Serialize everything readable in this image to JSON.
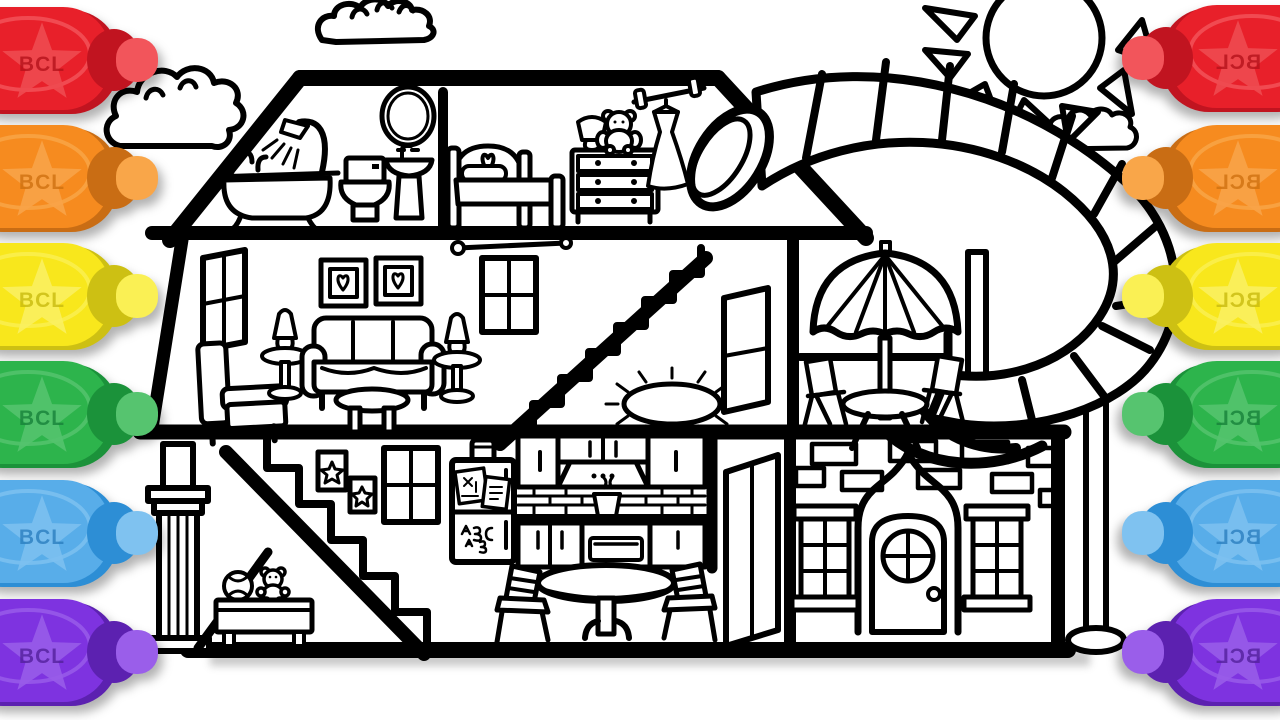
{
  "canvas": {
    "width": 1280,
    "height": 720,
    "background": "#ffffff",
    "line_color": "#000000"
  },
  "markers": {
    "label": "BCL",
    "left_order": [
      "red",
      "orange",
      "yellow",
      "green",
      "blue",
      "purple"
    ],
    "right_order": [
      "red",
      "orange",
      "yellow",
      "green",
      "blue",
      "purple"
    ],
    "palette": [
      {
        "name": "red",
        "body": "#e8202a",
        "shade": "#c11420",
        "tip": "#f2555b",
        "star": "#ee4a50",
        "label_color": "#b5121b",
        "vars": "--body:#e8202a;--shade:#c11420;--tip:#f2555b;--star:#ee4a50;--label:#b5121b"
      },
      {
        "name": "orange",
        "body": "#f68b1f",
        "shade": "#c96d14",
        "tip": "#f9a649",
        "star": "#f8a348",
        "label_color": "#cf7110",
        "vars": "--body:#f68b1f;--shade:#c96d14;--tip:#f9a649;--star:#f8a348;--label:#cf7110"
      },
      {
        "name": "yellow",
        "body": "#f8e71c",
        "shade": "#cdc013",
        "tip": "#faf054",
        "star": "#faef60",
        "label_color": "#c9bb0f",
        "vars": "--body:#f8e71c;--shade:#cdc013;--tip:#faf054;--star:#faef60;--label:#c9bb0f"
      },
      {
        "name": "green",
        "body": "#2db44c",
        "shade": "#1b923a",
        "tip": "#56c46f",
        "star": "#54c36e",
        "label_color": "#17823a",
        "vars": "--body:#2db44c;--shade:#1b923a;--tip:#56c46f;--star:#54c36e;--label:#17823a"
      },
      {
        "name": "blue",
        "body": "#58ade9",
        "shade": "#2d8ed5",
        "tip": "#7fc2f0",
        "star": "#7cc0ef",
        "label_color": "#2b7fc0",
        "vars": "--body:#58ade9;--shade:#2d8ed5;--tip:#7fc2f0;--star:#7cc0ef;--label:#2b7fc0"
      },
      {
        "name": "purple",
        "body": "#7e33e0",
        "shade": "#5c21b0",
        "tip": "#9a5eea",
        "star": "#985ce9",
        "label_color": "#53219c",
        "vars": "--body:#7e33e0;--shade:#5c21b0;--tip:#9a5eea;--star:#985ce9;--label:#53219c"
      }
    ]
  },
  "scene": {
    "objects": [
      "sun",
      "clouds",
      "dollhouse-cutaway",
      "bathroom",
      "bedroom",
      "living-room",
      "staircases",
      "patio-with-umbrella",
      "kitchen",
      "brick-facade-front-door",
      "spiral-slide",
      "support-poles",
      "column",
      "toy-bench"
    ]
  }
}
